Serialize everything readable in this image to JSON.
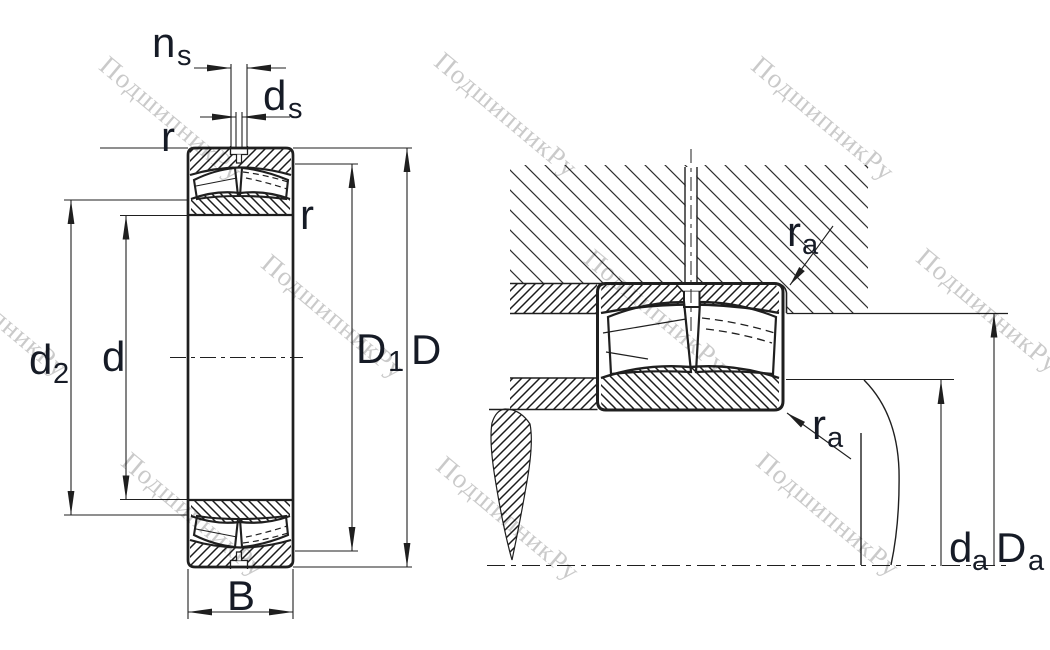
{
  "watermark": {
    "text": "ПодшипникРу"
  },
  "colors": {
    "line": "#1f1f1f",
    "label": "#161b26",
    "watermark": "#c8c8c8",
    "hatch_fine": "#1c1c1c",
    "hatch_housing": "#2e2e2e",
    "background": "#ffffff"
  },
  "left_view": {
    "labels": {
      "ns": {
        "base": "n",
        "sub": "s"
      },
      "ds": {
        "base": "d",
        "sub": "s"
      },
      "r_outer": {
        "base": "r"
      },
      "r_inner": {
        "base": "r"
      },
      "d2": {
        "base": "d",
        "sub": "2"
      },
      "d": {
        "base": "d"
      },
      "D1": {
        "base": "D",
        "sub": "1"
      },
      "D": {
        "base": "D"
      },
      "B": {
        "base": "B"
      }
    }
  },
  "right_view": {
    "labels": {
      "ra_housing": {
        "base": "r",
        "sub": "a"
      },
      "ra_shaft": {
        "base": "r",
        "sub": "a"
      },
      "da": {
        "base": "d",
        "sub": "a"
      },
      "Da": {
        "base": "D",
        "sub": "a"
      }
    }
  }
}
